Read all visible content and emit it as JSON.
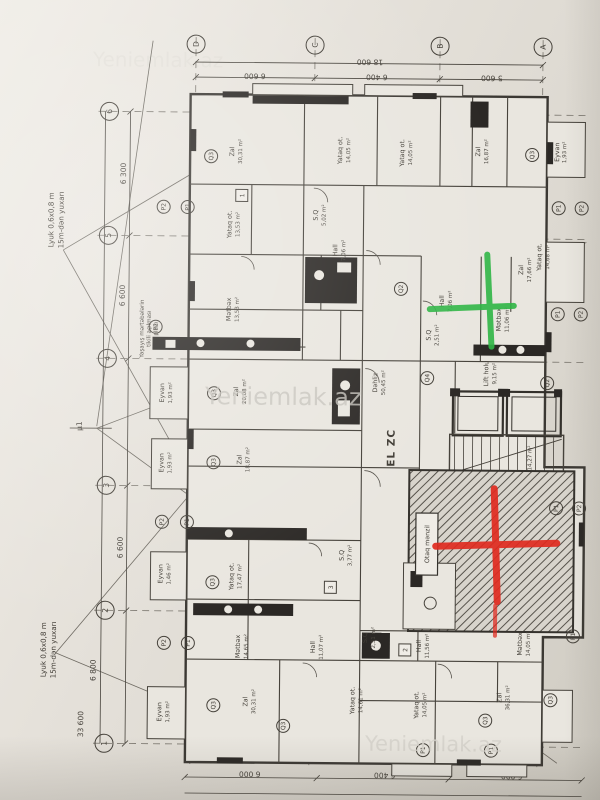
{
  "watermark": "Yeniemlak.az",
  "grid": {
    "top": [
      "D",
      "C",
      "B",
      "A"
    ],
    "left": [
      "6",
      "5",
      "4",
      "3",
      "2",
      "1"
    ]
  },
  "lbl": {
    "P1": "P1",
    "P2": "P2",
    "Q2": "Q2",
    "Q3": "Q3",
    "Q4": "Q4"
  },
  "tags": {
    "t1": "1",
    "t2": "2",
    "t3": "3"
  },
  "dimensions": {
    "top_total": "18 600",
    "top_segments": [
      "6 600",
      "6 400",
      "5 600"
    ],
    "bottom_segments": [
      "6 000",
      "6 400",
      "6 000"
    ],
    "left_labels": [
      "6 300",
      "6 600",
      "6 600",
      "6 800",
      "33 600"
    ]
  },
  "annotations": {
    "lyuk_line1": "Lyuk 0,6x0,8 m",
    "lyuk_line2": "15m-dən yuxarı",
    "note_line1": "Yaşayış mərtəbələrin",
    "note_line2": "tikili açılması",
    "note_line3": "planı",
    "el_zc": "EL ZC",
    "mu1": "µ1"
  },
  "core": {
    "dehliz_label": "Dəhliz",
    "dehliz_area": "50,45 m²",
    "lift_label": "Lift holu",
    "lift_area": "9,15 m²",
    "stairs_area": "14,27 m²",
    "otaq_menzil": "Otaq mənzil"
  },
  "markers": {
    "green": "#2fb646",
    "red": "#e02b20"
  },
  "rooms": [
    {
      "l": "Zal",
      "a": "30,31 m²"
    },
    {
      "l": "Yataq ot.",
      "a": "14,05 m²"
    },
    {
      "l": "Yataq ot.",
      "a": "14,05 m²"
    },
    {
      "l": "Zal",
      "a": "16,87 m²"
    },
    {
      "l": "Eyvan",
      "a": "1,93 m²"
    },
    {
      "l": "Yataq ot.",
      "a": "13,53 m²"
    },
    {
      "l": "S.Q",
      "a": "5,02 m²"
    },
    {
      "l": "Hall",
      "a": "7,06 m²"
    },
    {
      "l": "Yataq ot.",
      "a": "14,68 m²"
    },
    {
      "l": "Mətbəx",
      "a": "13,53 m²"
    },
    {
      "l": "Zal",
      "a": "20,08 m²"
    },
    {
      "l": "Zal",
      "a": "18,87 m²"
    },
    {
      "l": "Eyvan",
      "a": "1,93 m²"
    },
    {
      "l": "Eyvan",
      "a": "1,93 m²"
    },
    {
      "l": "Yataq ot.",
      "a": "17,47 m²"
    },
    {
      "l": "Eyvan",
      "a": "1,46 m²"
    },
    {
      "l": "Mətbəx",
      "a": "14,65 m²"
    },
    {
      "l": "Hall",
      "a": "11,07 m²"
    },
    {
      "l": "S.Q",
      "a": "3,77 m²"
    },
    {
      "l": "Zal",
      "a": "30,31 m²"
    },
    {
      "l": "Yataq ot.",
      "a": "14,61 m²"
    },
    {
      "l": "Yataq ot.",
      "a": "14,05 m²"
    },
    {
      "l": "Zal",
      "a": "36,31 m²"
    },
    {
      "l": "Hall",
      "a": "11,56 m²"
    },
    {
      "l": "Mətbəx",
      "a": "14,05 m²"
    },
    {
      "l": "S.Q",
      "a": "2,51 m²"
    },
    {
      "l": "Eyvan",
      "a": "1,93 m²"
    },
    {
      "l": "Hall",
      "a": "7,06 m²"
    },
    {
      "l": "Mətbəx",
      "a": "11,06 m²"
    },
    {
      "l": "Zal",
      "a": "17,66 m²"
    },
    {
      "l": "S.Q",
      "a": "2,51 m²"
    }
  ]
}
